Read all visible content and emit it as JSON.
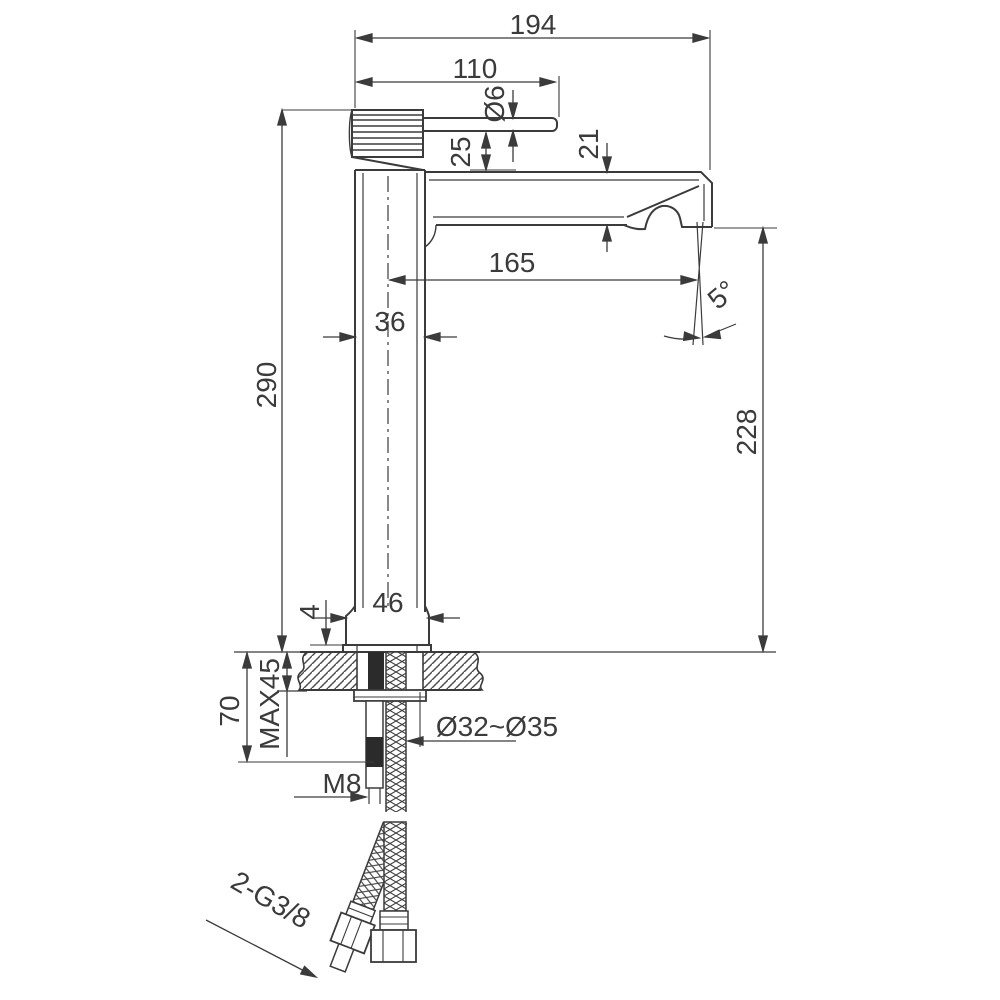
{
  "drawing": {
    "type": "technical-dimension-drawing",
    "subject": "tall single-lever basin mixer faucet, side elevation with installation dimensions",
    "dimensions": {
      "overall_width": "194",
      "handle_length": "110",
      "lever_bar_diameter": "Ø6",
      "lever_to_spout_gap": "25",
      "spout_section_height": "21",
      "spout_reach": "165",
      "body_width": "36",
      "total_height": "290",
      "outlet_height": "228",
      "outlet_angle": "5°",
      "base_width": "46",
      "base_plate_height": "4",
      "shank_length": "70",
      "max_deck_thickness": "MAX45",
      "mounting_hole_diameter": "Ø32~Ø35",
      "stud_thread": "M8",
      "supply_hose_thread": "2-G3/8"
    },
    "line_color": "#3b3b3b",
    "fill_black": "#2b2b2b"
  }
}
